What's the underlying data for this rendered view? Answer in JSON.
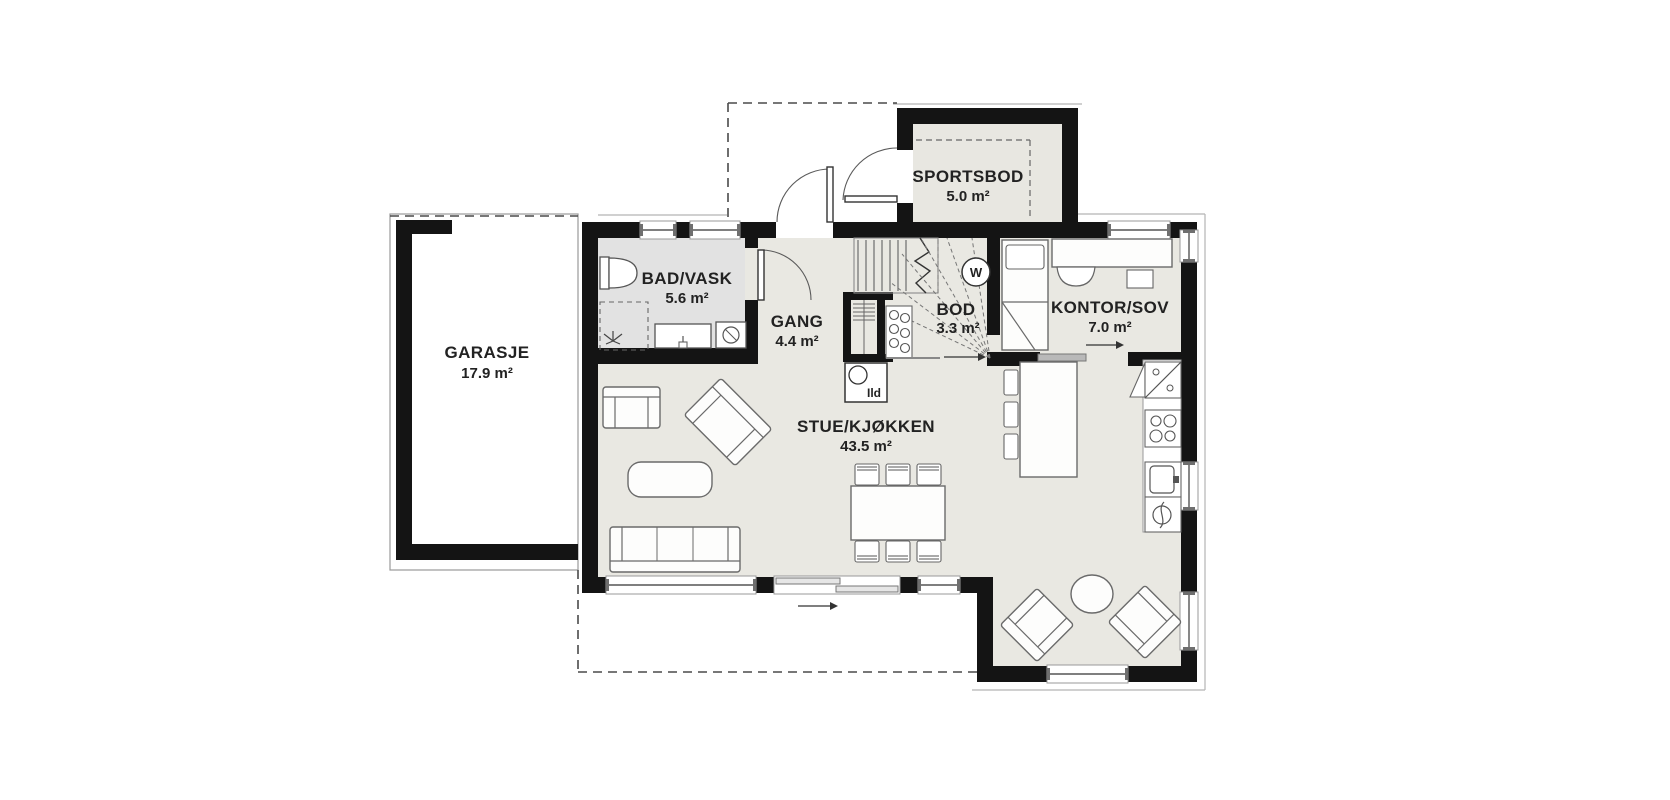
{
  "drawing": {
    "type": "floor-plan",
    "background": "#ffffff"
  },
  "rooms": {
    "garasje": {
      "name": "GARASJE",
      "area": "17.9 m²"
    },
    "bad_vask": {
      "name": "BAD/VASK",
      "area": "5.6 m²"
    },
    "gang": {
      "name": "GANG",
      "area": "4.4 m²"
    },
    "sportsbod": {
      "name": "SPORTSBOD",
      "area": "5.0 m²"
    },
    "bod": {
      "name": "BOD",
      "area": "3.3 m²"
    },
    "kontor_sov": {
      "name": "KONTOR/SOV",
      "area": "7.0 m²"
    },
    "stue_kjokken": {
      "name": "STUE/KJØKKEN",
      "area": "43.5 m²"
    }
  },
  "annotations": {
    "fireplace_label": "Ild",
    "water_heater_label": "W"
  },
  "colors": {
    "wall": "#141414",
    "floor_main": "#e9e8e2",
    "floor_bathroom": "#e2e2e2",
    "floor_sportsbod": "#e8e7e1",
    "floor_garage": "#ffffff",
    "outline_thin": "#b5b5b5",
    "text": "#222222"
  },
  "fixtures": [
    "toilet-icon",
    "shower-icon",
    "bath-sink-icon",
    "washing-machine-icon",
    "stairs-icon",
    "water-heater-icon",
    "wood-stove-icon",
    "wardrobe-shelf-icon",
    "bod-shelf-icon",
    "fridge-icon",
    "cooktop-icon",
    "kitchen-sink-icon",
    "dishwasher-icon",
    "kitchen-island-icon",
    "bar-stool-icon",
    "bed-icon",
    "desk-icon",
    "desk-chair-icon",
    "sofa-icon",
    "loveseat-icon",
    "armchair-icon",
    "coffee-table-icon",
    "dining-table-icon",
    "dining-chair-icon",
    "round-table-icon",
    "lounge-chair-icon"
  ]
}
